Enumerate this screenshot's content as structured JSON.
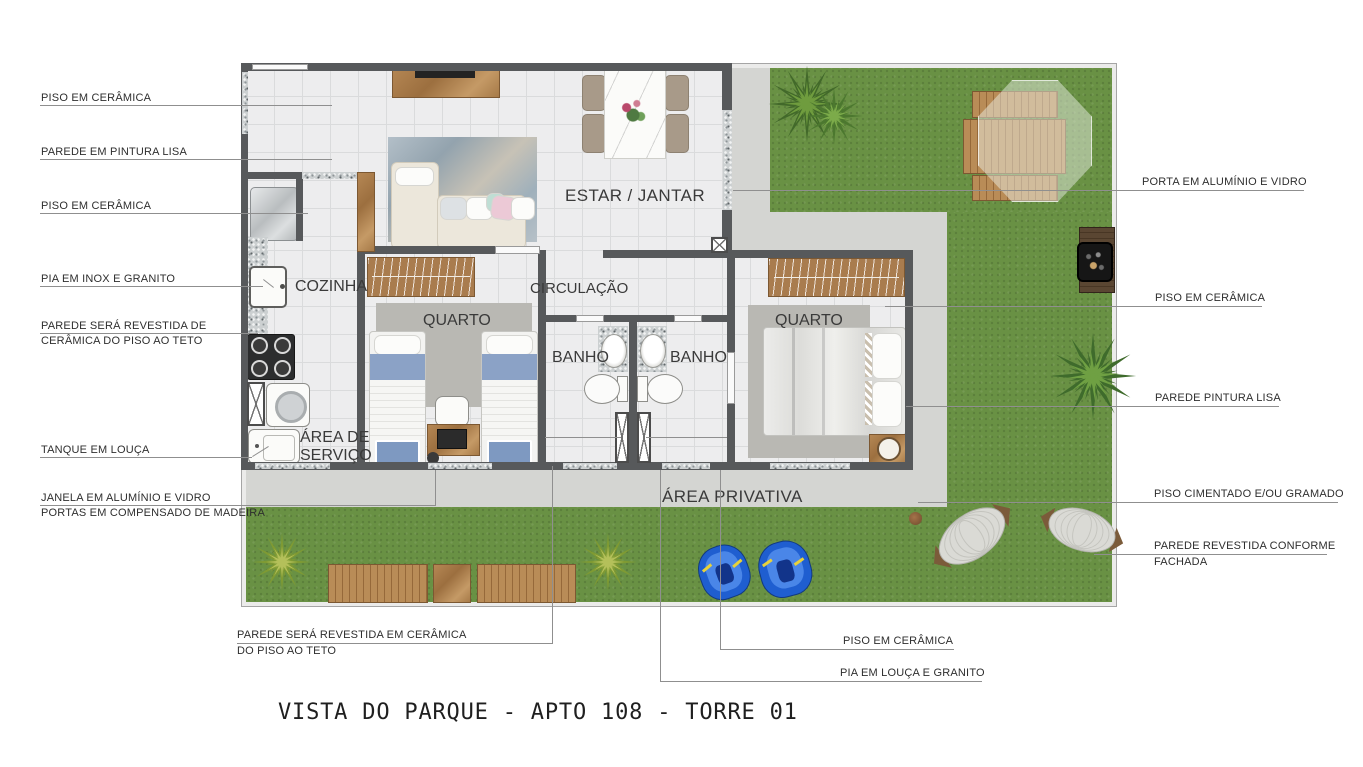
{
  "title": "VISTA DO PARQUE - APTO 108 - TORRE 01",
  "rooms": {
    "estar_jantar": "ESTAR / JANTAR",
    "cozinha": "COZINHA",
    "quarto1": "QUARTO",
    "circulacao": "CIRCULAÇÃO",
    "banho1": "BANHO",
    "banho2": "BANHO",
    "quarto2": "QUARTO",
    "area_servico_1": "ÁREA DE",
    "area_servico_2": "SERVIÇO",
    "area_privativa": "ÁREA PRIVATIVA"
  },
  "annotations": {
    "left": [
      {
        "text": "PISO EM CERÂMICA"
      },
      {
        "text": "PAREDE EM PINTURA LISA"
      },
      {
        "text": "PISO EM CERÂMICA"
      },
      {
        "text": "PIA EM INOX E GRANITO"
      },
      {
        "text": "PAREDE SERÁ REVESTIDA DE",
        "text2": "CERÂMICA DO PISO AO TETO"
      },
      {
        "text": "TANQUE EM LOUÇA"
      },
      {
        "text": "JANELA EM ALUMÍNIO E VIDRO",
        "text2": "PORTAS EM COMPENSADO DE MADEIRA"
      }
    ],
    "right": [
      {
        "text": "PORTA EM ALUMÍNIO E VIDRO"
      },
      {
        "text": "PISO EM CERÂMICA"
      },
      {
        "text": "PAREDE PINTURA LISA"
      },
      {
        "text": "PISO CIMENTADO E/OU GRAMADO"
      },
      {
        "text": "PAREDE REVESTIDA CONFORME",
        "text2": "FACHADA"
      }
    ],
    "bottom": [
      {
        "text": "PAREDE SERÁ REVESTIDA EM CERÂMICA",
        "text2": "DO PISO AO TETO"
      },
      {
        "text": "PISO EM CERÂMICA"
      },
      {
        "text": "PIA EM LOUÇA E GRANITO"
      }
    ]
  },
  "colors": {
    "grass": "#699144",
    "path": "#d4d5d2",
    "wall": "#57595b",
    "wood": "#a97c4e",
    "bed_blue": "#8ba2c6",
    "float_blue": "#1f5ed0"
  }
}
